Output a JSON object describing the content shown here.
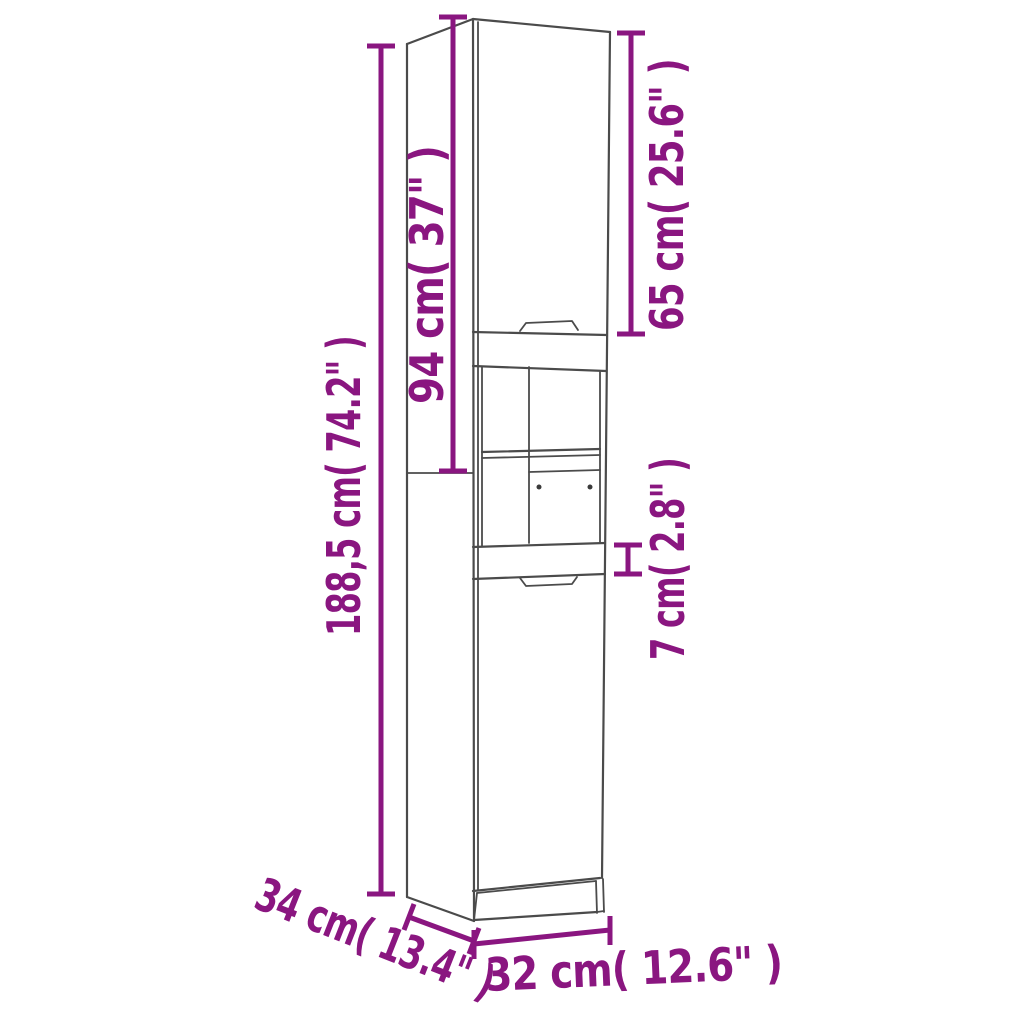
{
  "diagram": {
    "type": "product-dimension-diagram",
    "subject": "tall-bathroom-cabinet",
    "background_color": "#ffffff",
    "outline_color": "#4b4b4b",
    "dimension_color": "#8a1680",
    "labels": {
      "overall_height": "188,5 cm( 74.2\" )",
      "upper_section_height": "94 cm( 37\" )",
      "upper_door_height": "65 cm( 25.6\" )",
      "middle_rail_height": "7 cm( 2.8\" )",
      "depth": "34 cm( 13.4\" )",
      "width": "32 cm( 12.6\" )"
    }
  }
}
